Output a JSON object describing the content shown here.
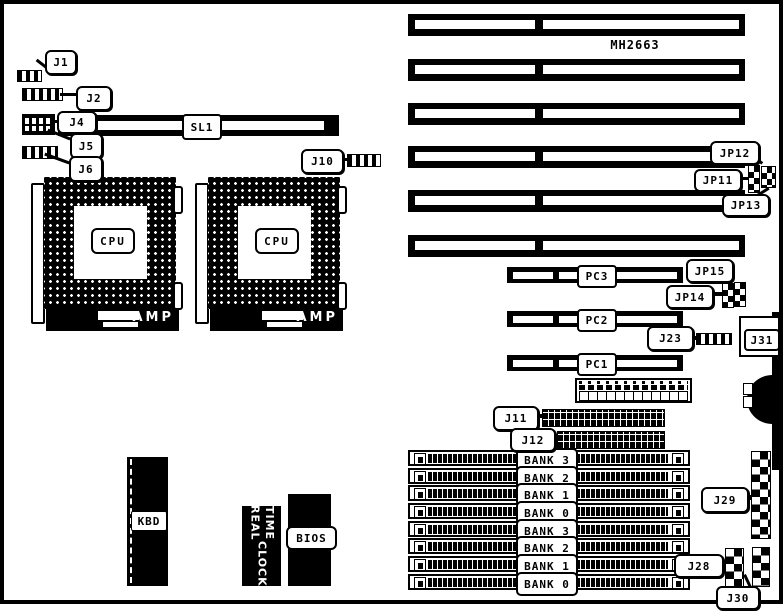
{
  "board": {
    "model": "MH2663",
    "line_color": "#000000",
    "background": "#ffffff"
  },
  "cpu": {
    "label": "CPU",
    "brand": "AMP"
  },
  "slots": {
    "sl1": "SL1",
    "pci": [
      "PC3",
      "PC2",
      "PC1"
    ]
  },
  "banks": [
    "BANK 3",
    "BANK 2",
    "BANK 1",
    "BANK 0",
    "BANK 3",
    "BANK 2",
    "BANK 1",
    "BANK 0"
  ],
  "callouts": {
    "j1": "J1",
    "j2": "J2",
    "j4": "J4",
    "j5": "J5",
    "j6": "J6",
    "j10": "J10",
    "jp12": "JP12",
    "jp11": "JP11",
    "jp13": "JP13",
    "jp15": "JP15",
    "jp14": "JP14",
    "j23": "J23",
    "j31": "J31",
    "j11": "J11",
    "j12": "J12",
    "j29": "J29",
    "j28": "J28",
    "j30": "J30"
  },
  "chips": {
    "kbd": "KBD",
    "rtc_line1": "REAL TIME",
    "rtc_line2": "CLOCK",
    "bios": "BIOS"
  }
}
